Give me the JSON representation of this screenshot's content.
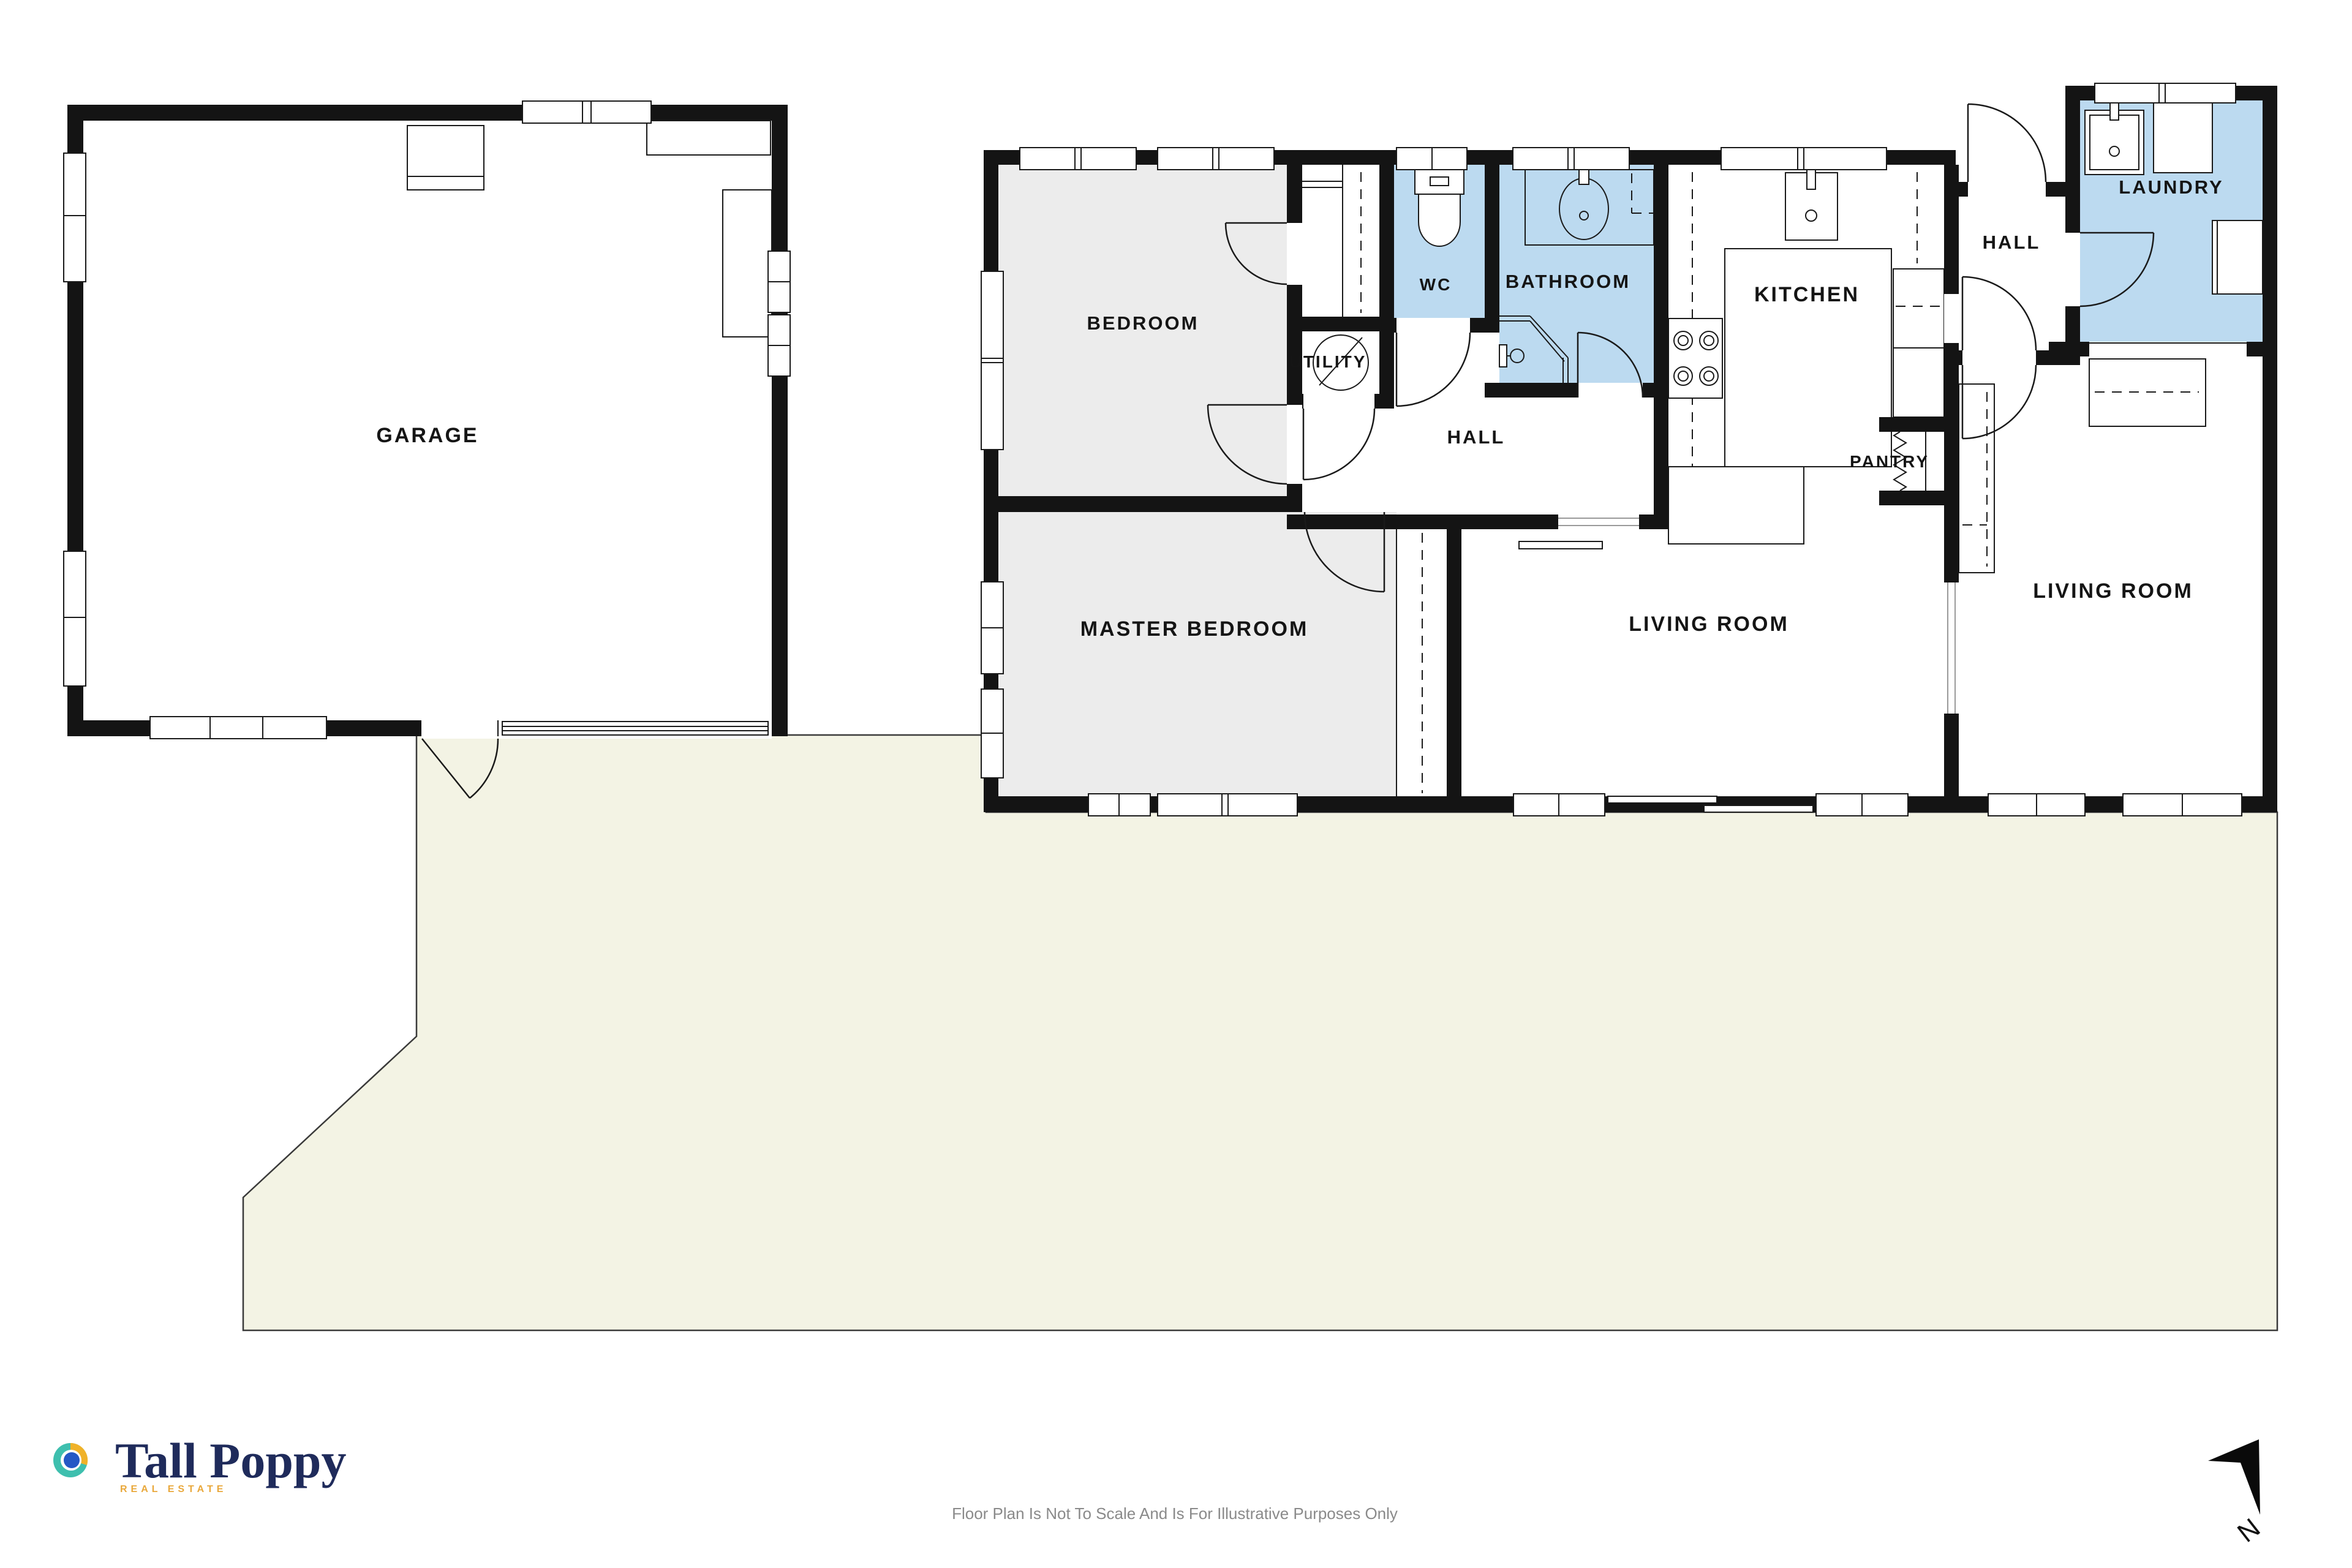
{
  "rooms": {
    "garage": "GARAGE",
    "bedroom": "BEDROOM",
    "master_bedroom": "MASTER BEDROOM",
    "wc": "WC",
    "bathroom": "BATHROOM",
    "utility": "UTILITY",
    "hall_middle": "HALL",
    "kitchen": "KITCHEN",
    "pantry": "PANTRY",
    "hall_right": "HALL",
    "laundry": "LAUNDRY",
    "living_room_middle": "LIVING ROOM",
    "living_room_right": "LIVING ROOM"
  },
  "compass": {
    "north_label": "N"
  },
  "branding": {
    "name": "Tall Poppy",
    "tagline": "REAL ESTATE"
  },
  "disclaimer": "Floor Plan Is Not To Scale And Is For Illustrative Purposes Only",
  "palette": {
    "wall": "#141414",
    "wet_room_fill": "#BCDAF0",
    "bedroom_fill": "#ECECEC",
    "yard_fill": "#F3F3E4",
    "brand_navy": "#1F2B5B",
    "brand_gold": "#E9A83B",
    "brand_teal": "#3EBFAE",
    "brand_blue": "#2458C5",
    "disclaimer_text": "#8A8A8A"
  }
}
